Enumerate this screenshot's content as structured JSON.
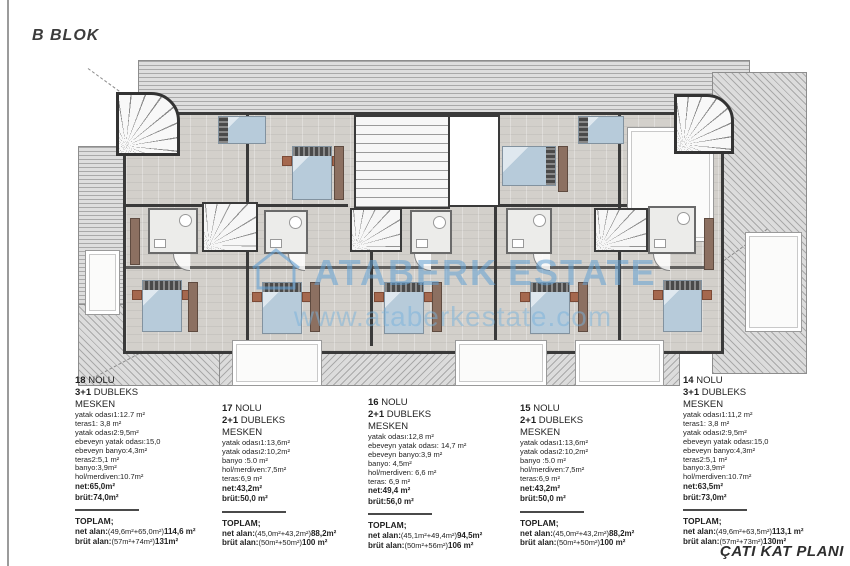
{
  "header": {
    "block_title": "B BLOK"
  },
  "footer": {
    "plan_title": "ÇATI KAT PLANI"
  },
  "watermark": {
    "brand_left": "ATABERK",
    "brand_right": "ESTATE",
    "url": "www.ataberkestate.com"
  },
  "palette": {
    "wall": "#3a3a3a",
    "floor": "#d3d0cb",
    "roof_hatch": "#dcdcdc",
    "bed_blue": "#b7cbda",
    "furniture_brown": "#8c7061",
    "watermark_blue": "#64a5d7"
  },
  "units": [
    {
      "number": "18",
      "number_suffix": "NOLU",
      "type_bold": "3+1",
      "type_suffix": "DUBLEKS",
      "category": "MESKEN",
      "rooms": [
        "yatak odası1:12.7 m²",
        "teras1: 3,8 m²",
        "yatak odası2:9,5m²",
        "ebeveyn yatak odası:15,0",
        "ebeveyn banyo:4,3m²",
        "teras2:5,1 m²",
        "banyo:3,9m²",
        "hol/merdiven:10.7m²"
      ],
      "net": "net:65,0m²",
      "brut": "brüt:74,0m²",
      "toplam": {
        "label": "TOPLAM;",
        "net_label": "net alan:",
        "net_formula": "(49,6m²+65,0m²)",
        "net_total": "114,6 m²",
        "brut_label": "brüt alan:",
        "brut_formula": "(57m²+74m²)",
        "brut_total": "131m²"
      }
    },
    {
      "number": "17",
      "number_suffix": "NOLU",
      "type_bold": "2+1",
      "type_suffix": "DUBLEKS",
      "category": "MESKEN",
      "rooms": [
        "yatak odası1:13,6m²",
        "yatak odası2:10,2m²",
        "banyo :5.0 m²",
        "hol/merdiven:7,5m²",
        "teras:6,9 m²"
      ],
      "net": "net:43,2m²",
      "brut": "brüt:50,0 m²",
      "toplam": {
        "label": "TOPLAM;",
        "net_label": "net alan:",
        "net_formula": "(45,0m²+43,2m²)",
        "net_total": "88,2m²",
        "brut_label": "brüt alan:",
        "brut_formula": "(50m²+50m²)",
        "brut_total": "100 m²"
      }
    },
    {
      "number": "16",
      "number_suffix": "NOLU",
      "type_bold": "2+1",
      "type_suffix": "DUBLEKS",
      "category": "MESKEN",
      "rooms": [
        "yatak odası:12,8 m²",
        "ebeveyn yatak odası: 14,7 m²",
        "ebeveyn banyo:3,9 m²",
        "banyo: 4,5m²",
        "hol/merdiven: 6,6 m²",
        "teras: 6,9 m²"
      ],
      "net": "net:49,4 m²",
      "brut": "brüt:56,0 m²",
      "toplam": {
        "label": "TOPLAM;",
        "net_label": "net alan:",
        "net_formula": "(45,1m²+49,4m²)",
        "net_total": "94,5m²",
        "brut_label": "brüt alan:",
        "brut_formula": "(50m²+56m²)",
        "brut_total": "106 m²"
      }
    },
    {
      "number": "15",
      "number_suffix": "NOLU",
      "type_bold": "2+1",
      "type_suffix": "DUBLEKS",
      "category": "MESKEN",
      "rooms": [
        "yatak odası1:13,6m²",
        "yatak odası2:10,2m²",
        "banyo :5.0 m²",
        "hol/merdiven:7,5m²",
        "teras:6,9 m²"
      ],
      "net": "net:43,2m²",
      "brut": "brüt:50,0 m²",
      "toplam": {
        "label": "TOPLAM;",
        "net_label": "net alan:",
        "net_formula": "(45,0m²+43,2m²)",
        "net_total": "88,2m²",
        "brut_label": "brüt alan:",
        "brut_formula": "(50m²+50m²)",
        "brut_total": "100 m²"
      }
    },
    {
      "number": "14",
      "number_suffix": "NOLU",
      "type_bold": "3+1",
      "type_suffix": "DUBLEKS",
      "category": "MESKEN",
      "rooms": [
        "yatak odası1:11,2 m²",
        "teras1: 3,8 m²",
        "yatak odası2:9,5m²",
        "ebeveyn yatak odası:15,0",
        "ebeveyn banyo:4,3m²",
        "teras2:5,1 m²",
        "banyo:3,9m²",
        "hol/merdiven:10.7m²"
      ],
      "net": "net:63,5m²",
      "brut": "brüt:73,0m²",
      "toplam": {
        "label": "TOPLAM;",
        "net_label": "net alan:",
        "net_formula": "(49,6m²+63,5m²)",
        "net_total": "113,1 m²",
        "brut_label": "brüt alan:",
        "brut_formula": "(57m²+73m²)",
        "brut_total": "130m²"
      }
    }
  ]
}
